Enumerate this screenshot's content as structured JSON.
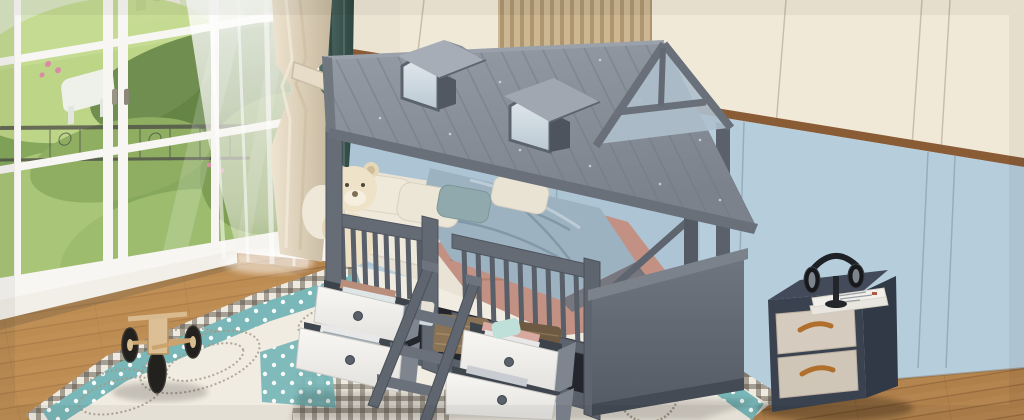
{
  "scene": "kids-bedroom-product-photo",
  "palette": {
    "wall-cream": "#ece4d3",
    "wall-cream-lt": "#f5eddc",
    "wall-blue": "#b6cddc",
    "trim-brown": "#8a5c36",
    "slat-wood": "#c9b18b",
    "floor-wood": "#b5854f",
    "floor-seam": "#8f6237",
    "roof": "#878e98",
    "roof-dark": "#6a717b",
    "frame-gray": "#626973",
    "frame-dark": "#4c525c",
    "drawer-white": "#f3f2ef",
    "mirror": "#cdd9e1",
    "bedding-cream": "#e9e3d6",
    "blanket-salmon": "#c39183",
    "duvet-blue": "#9db2c1",
    "pillow-teal": "#8fa9ad",
    "curtain-cream": "#e4d9c4",
    "curtain-teal": "#415c57",
    "rug-white": "#f1ece1",
    "rug-teal": "#7ab7b8",
    "rug-check": "#5c5246",
    "garden-green": "#85a85c",
    "garden-light": "#c3d98c",
    "nightstand-dark": "#3a4250",
    "nightstand-drawer": "#d5cbbe",
    "handle-wood": "#b06f2c",
    "teddy": "#ecdfc4",
    "basket": "#8a7254",
    "tire": "#23211e",
    "toy-wood": "#dcbf94",
    "book": "#f1efe9",
    "headphone": "#1d2025"
  },
  "objects": {
    "window": {
      "name": "french-window",
      "grid": "white-muntins",
      "view": "garden-greenery-with-iron-railing"
    },
    "curtains": {
      "sheer": "white",
      "drape": "cream-with-tieback",
      "accent": "teal"
    },
    "walls": {
      "upper": "cream-panels",
      "lower": "light-blue-wainscot",
      "accent": "wood-slat-panel",
      "divider": "brown-trim"
    },
    "floor": {
      "material": "wood-planks"
    },
    "bed": {
      "name": "gray-house-frame-bed",
      "roof_dormers": 2,
      "rail_sections": 2,
      "storage_drawers": 4,
      "drawer_color": "white",
      "ladder_steps": 3,
      "under_bed_baskets": 2
    },
    "bedding": {
      "cream_pillows": 3,
      "teal_pillows": 1,
      "blanket": "salmon",
      "duvet": "slate-blue",
      "sheet": "cream"
    },
    "rug": {
      "style": "patchwork",
      "patterns": [
        "teal-polka-band",
        "gingham-check",
        "leaf-scribbles",
        "bear-motif"
      ],
      "border": "dark-check"
    },
    "nightstand": {
      "body": "dark-gray",
      "drawers": 2,
      "drawer_color": "cream",
      "handles": "wood",
      "items_on_top": [
        "headphones",
        "books"
      ]
    },
    "toys": [
      "teddy-bear",
      "plush-cushion",
      "wooden-tricycle"
    ]
  }
}
